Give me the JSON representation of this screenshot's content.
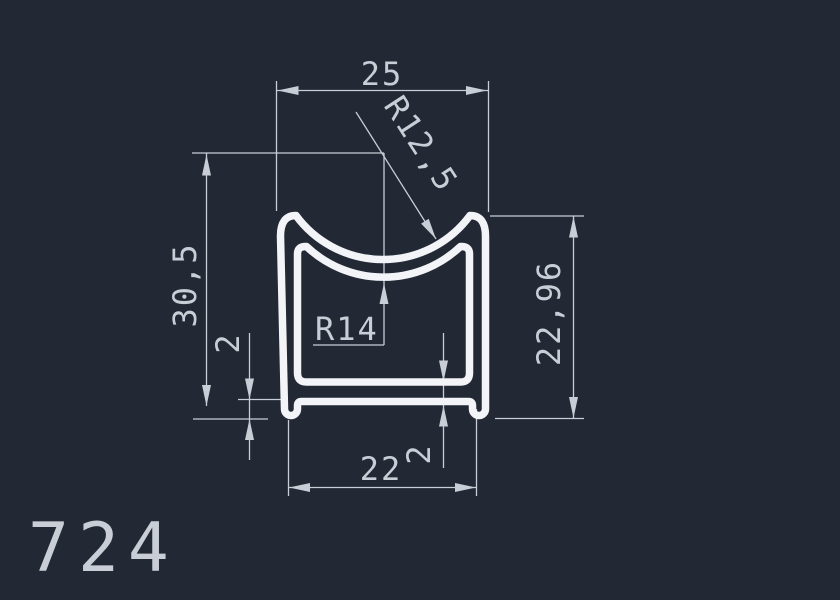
{
  "drawing": {
    "profile_number": "724",
    "labels": {
      "top_width": "25",
      "outer_radius": "R12,5",
      "inner_radius": "R14",
      "left_height": "30,5",
      "right_height": "22,96",
      "bottom_width": "22",
      "foot_height": "2",
      "bottom_wall_thickness": "2"
    },
    "colors": {
      "background": "#222834",
      "profile_line": "#f2f4f7",
      "dimension_line": "#c9ced6"
    }
  }
}
